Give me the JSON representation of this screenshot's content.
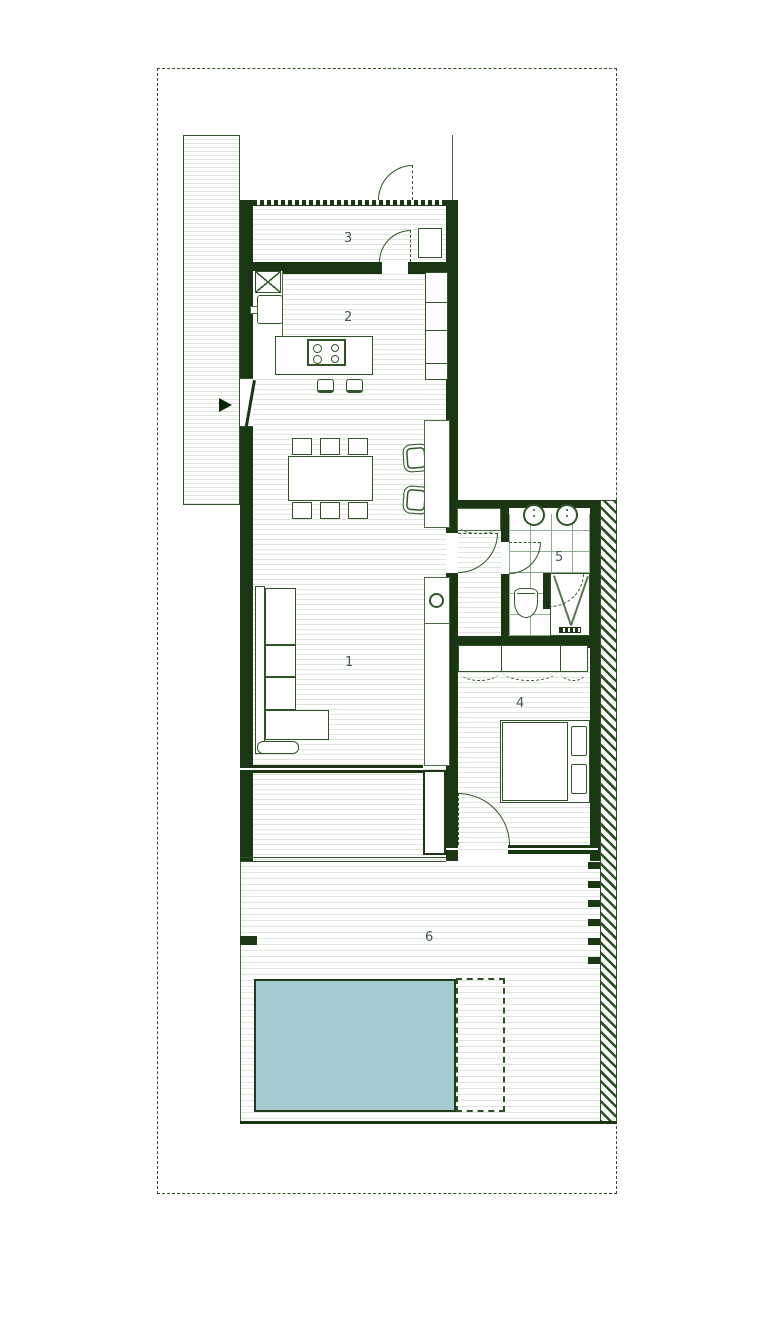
{
  "title": "floor-plan",
  "rooms": [
    {
      "label": "1"
    },
    {
      "label": "2"
    },
    {
      "label": "3"
    },
    {
      "label": "4"
    },
    {
      "label": "5"
    },
    {
      "label": "6"
    }
  ],
  "colors": {
    "wall": "#1a3612",
    "line": "#2e5526",
    "thin": "#4a6a40",
    "label": "#46565c",
    "stripe": "#dfe6db",
    "tile": "#8fae8f",
    "hatch": "#2c5124",
    "pool_fill": "#a5cbd1",
    "pool_border": "#1e3d1a",
    "boundary": "#2f5228",
    "arrow": "#0d2408"
  },
  "fixtures": {
    "entrance_arrow": "css-triangle",
    "cooktop": "rect-with-4-burner-circles",
    "kitchen_sink": "rounded-rect-with-faucet",
    "pantry_cabinet": "x-crossed-box",
    "dining_table": "rect-with-6-chairs",
    "armchairs": "two-rounded-squares",
    "sofa": "l-shaped-sectional",
    "round_table": "small-circle",
    "bathroom_sinks": "two-circles",
    "toilet": "rounded-bowl",
    "shower": "box-with-v-drain-lines",
    "wardrobe": "rect-with-dashed-swings",
    "double_bed": "rect-with-two-pillows",
    "pool": "teal-rectangle",
    "pool_deck": "dashed-rectangle"
  }
}
